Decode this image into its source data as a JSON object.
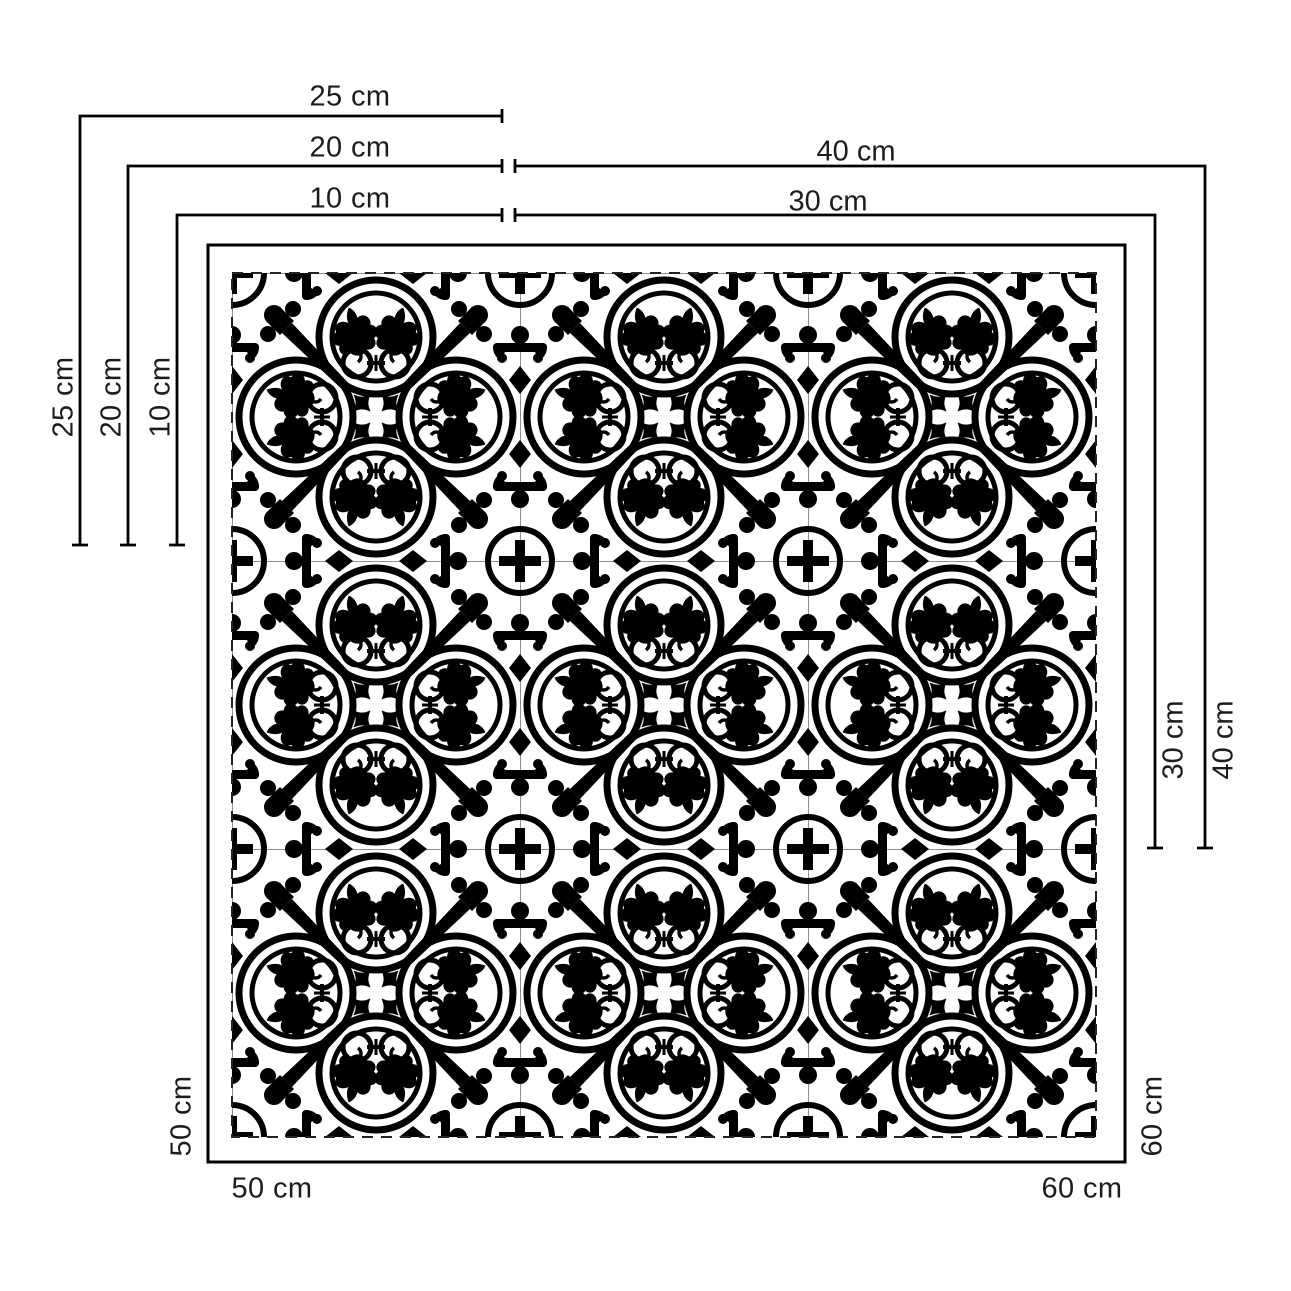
{
  "diagram": {
    "description": "Tile pattern size diagram with dimension lines",
    "colors": {
      "ink": "#000000",
      "background": "#ffffff",
      "hairline": "#909090"
    },
    "tile_grid": {
      "rows": 3,
      "cols": 3
    },
    "unit": "cm",
    "labels": {
      "top_h_25": "25 cm",
      "top_h_20": "20 cm",
      "top_h_10": "10 cm",
      "top_h_40": "40 cm",
      "top_h_30": "30 cm",
      "left_v_25": "25 cm",
      "left_v_20": "20 cm",
      "left_v_10": "10 cm",
      "right_v_30": "30 cm",
      "right_v_40": "40 cm",
      "bottom_h_50": "50 cm",
      "bottom_h_60": "60 cm",
      "left_v_50": "50 cm",
      "right_v_60": "60 cm"
    }
  }
}
